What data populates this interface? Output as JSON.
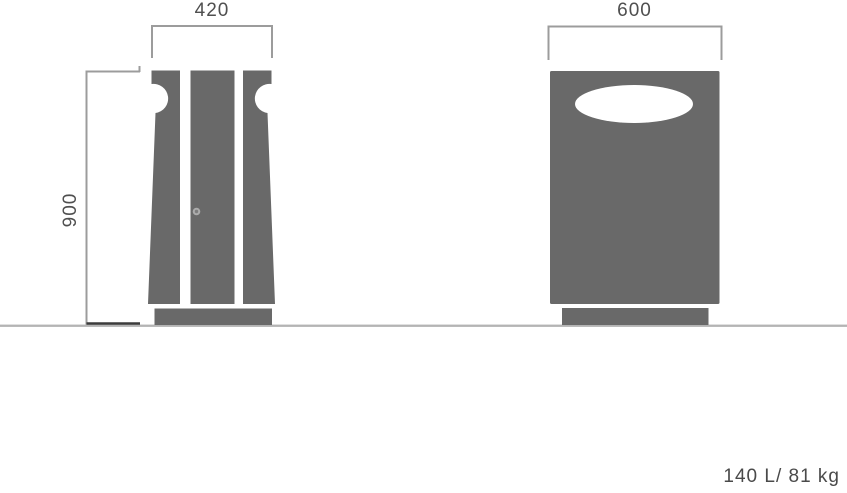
{
  "meta": {
    "type": "technical-dimension-drawing",
    "subject": "litter bin, side and front elevation views"
  },
  "labels": {
    "side_view_width_mm": "420",
    "front_view_width_mm": "600",
    "height_mm": "900",
    "spec": "140 L/ 81 kg"
  },
  "views": {
    "side": "side elevation with three vertical panels, circular notches at rim and lock detail",
    "front": "front elevation with elliptical opening"
  },
  "colors": {
    "body": "#696969",
    "line": "#9c9c9c",
    "line_dark": "#3b3b3b",
    "ground": "#b4b4b4",
    "text": "#4f4f4f",
    "opening": "#ffffff",
    "lock_outer": "#ababab",
    "lock_inner": "#7d7d7d",
    "background": "#ffffff"
  }
}
